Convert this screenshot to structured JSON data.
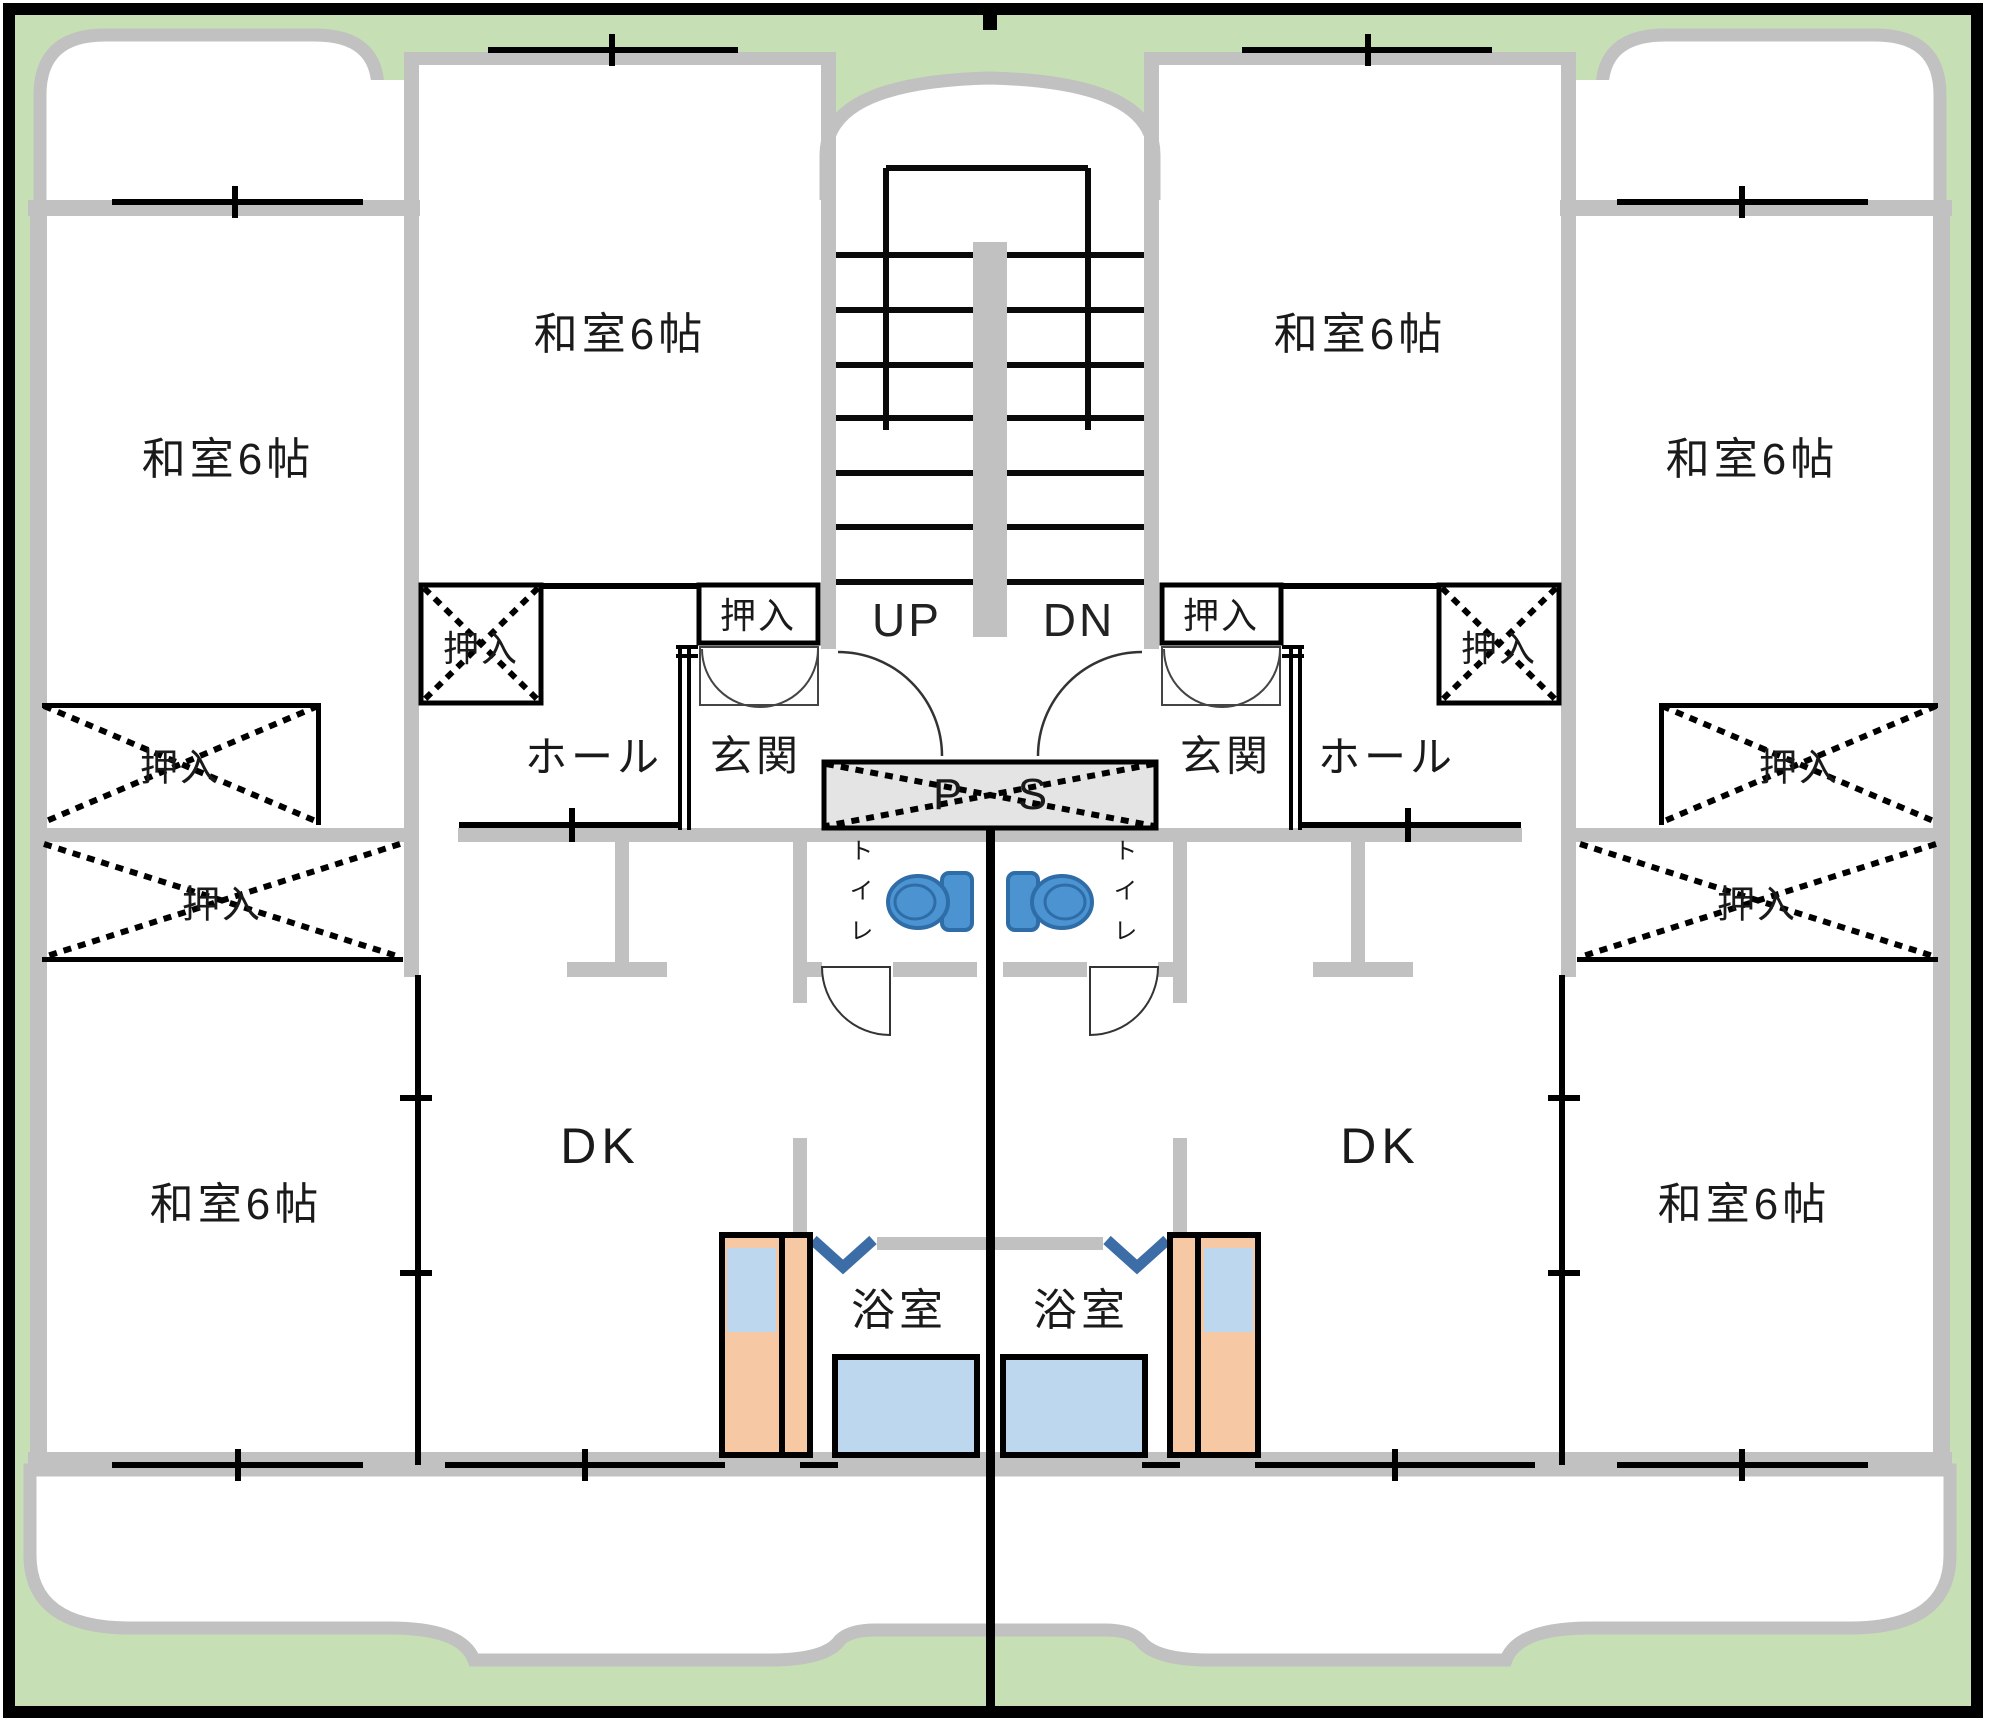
{
  "plan": {
    "description": "Symmetric two-unit apartment floor plan with central staircase",
    "labels": {
      "washitsu": "和室6帖",
      "oshiire": "押入",
      "hall": "ホール",
      "genkan": "玄関",
      "toilet": "トイレ",
      "bath": "浴室",
      "dk": "DK",
      "up": "UP",
      "dn": "DN",
      "ps": "P S"
    },
    "units": [
      "left",
      "right"
    ],
    "rooms_per_unit": {
      "washitsu_count": 3,
      "has_dk": true,
      "has_bath": true,
      "has_toilet": true,
      "has_genkan": true,
      "has_hall": true,
      "closet_count": 4
    },
    "colors": {
      "lawn_green": "#c7dfb5",
      "wall_gray": "#c1c1c1",
      "ps_fill": "#e4e4e4",
      "water_blue": "#bdd7ee",
      "counter_orange": "#f6c9a4",
      "toilet_blue": "#4b94d1",
      "toilet_outline": "#2f6da8",
      "door_check_blue": "#3d6da6",
      "line_black": "#000000"
    }
  }
}
